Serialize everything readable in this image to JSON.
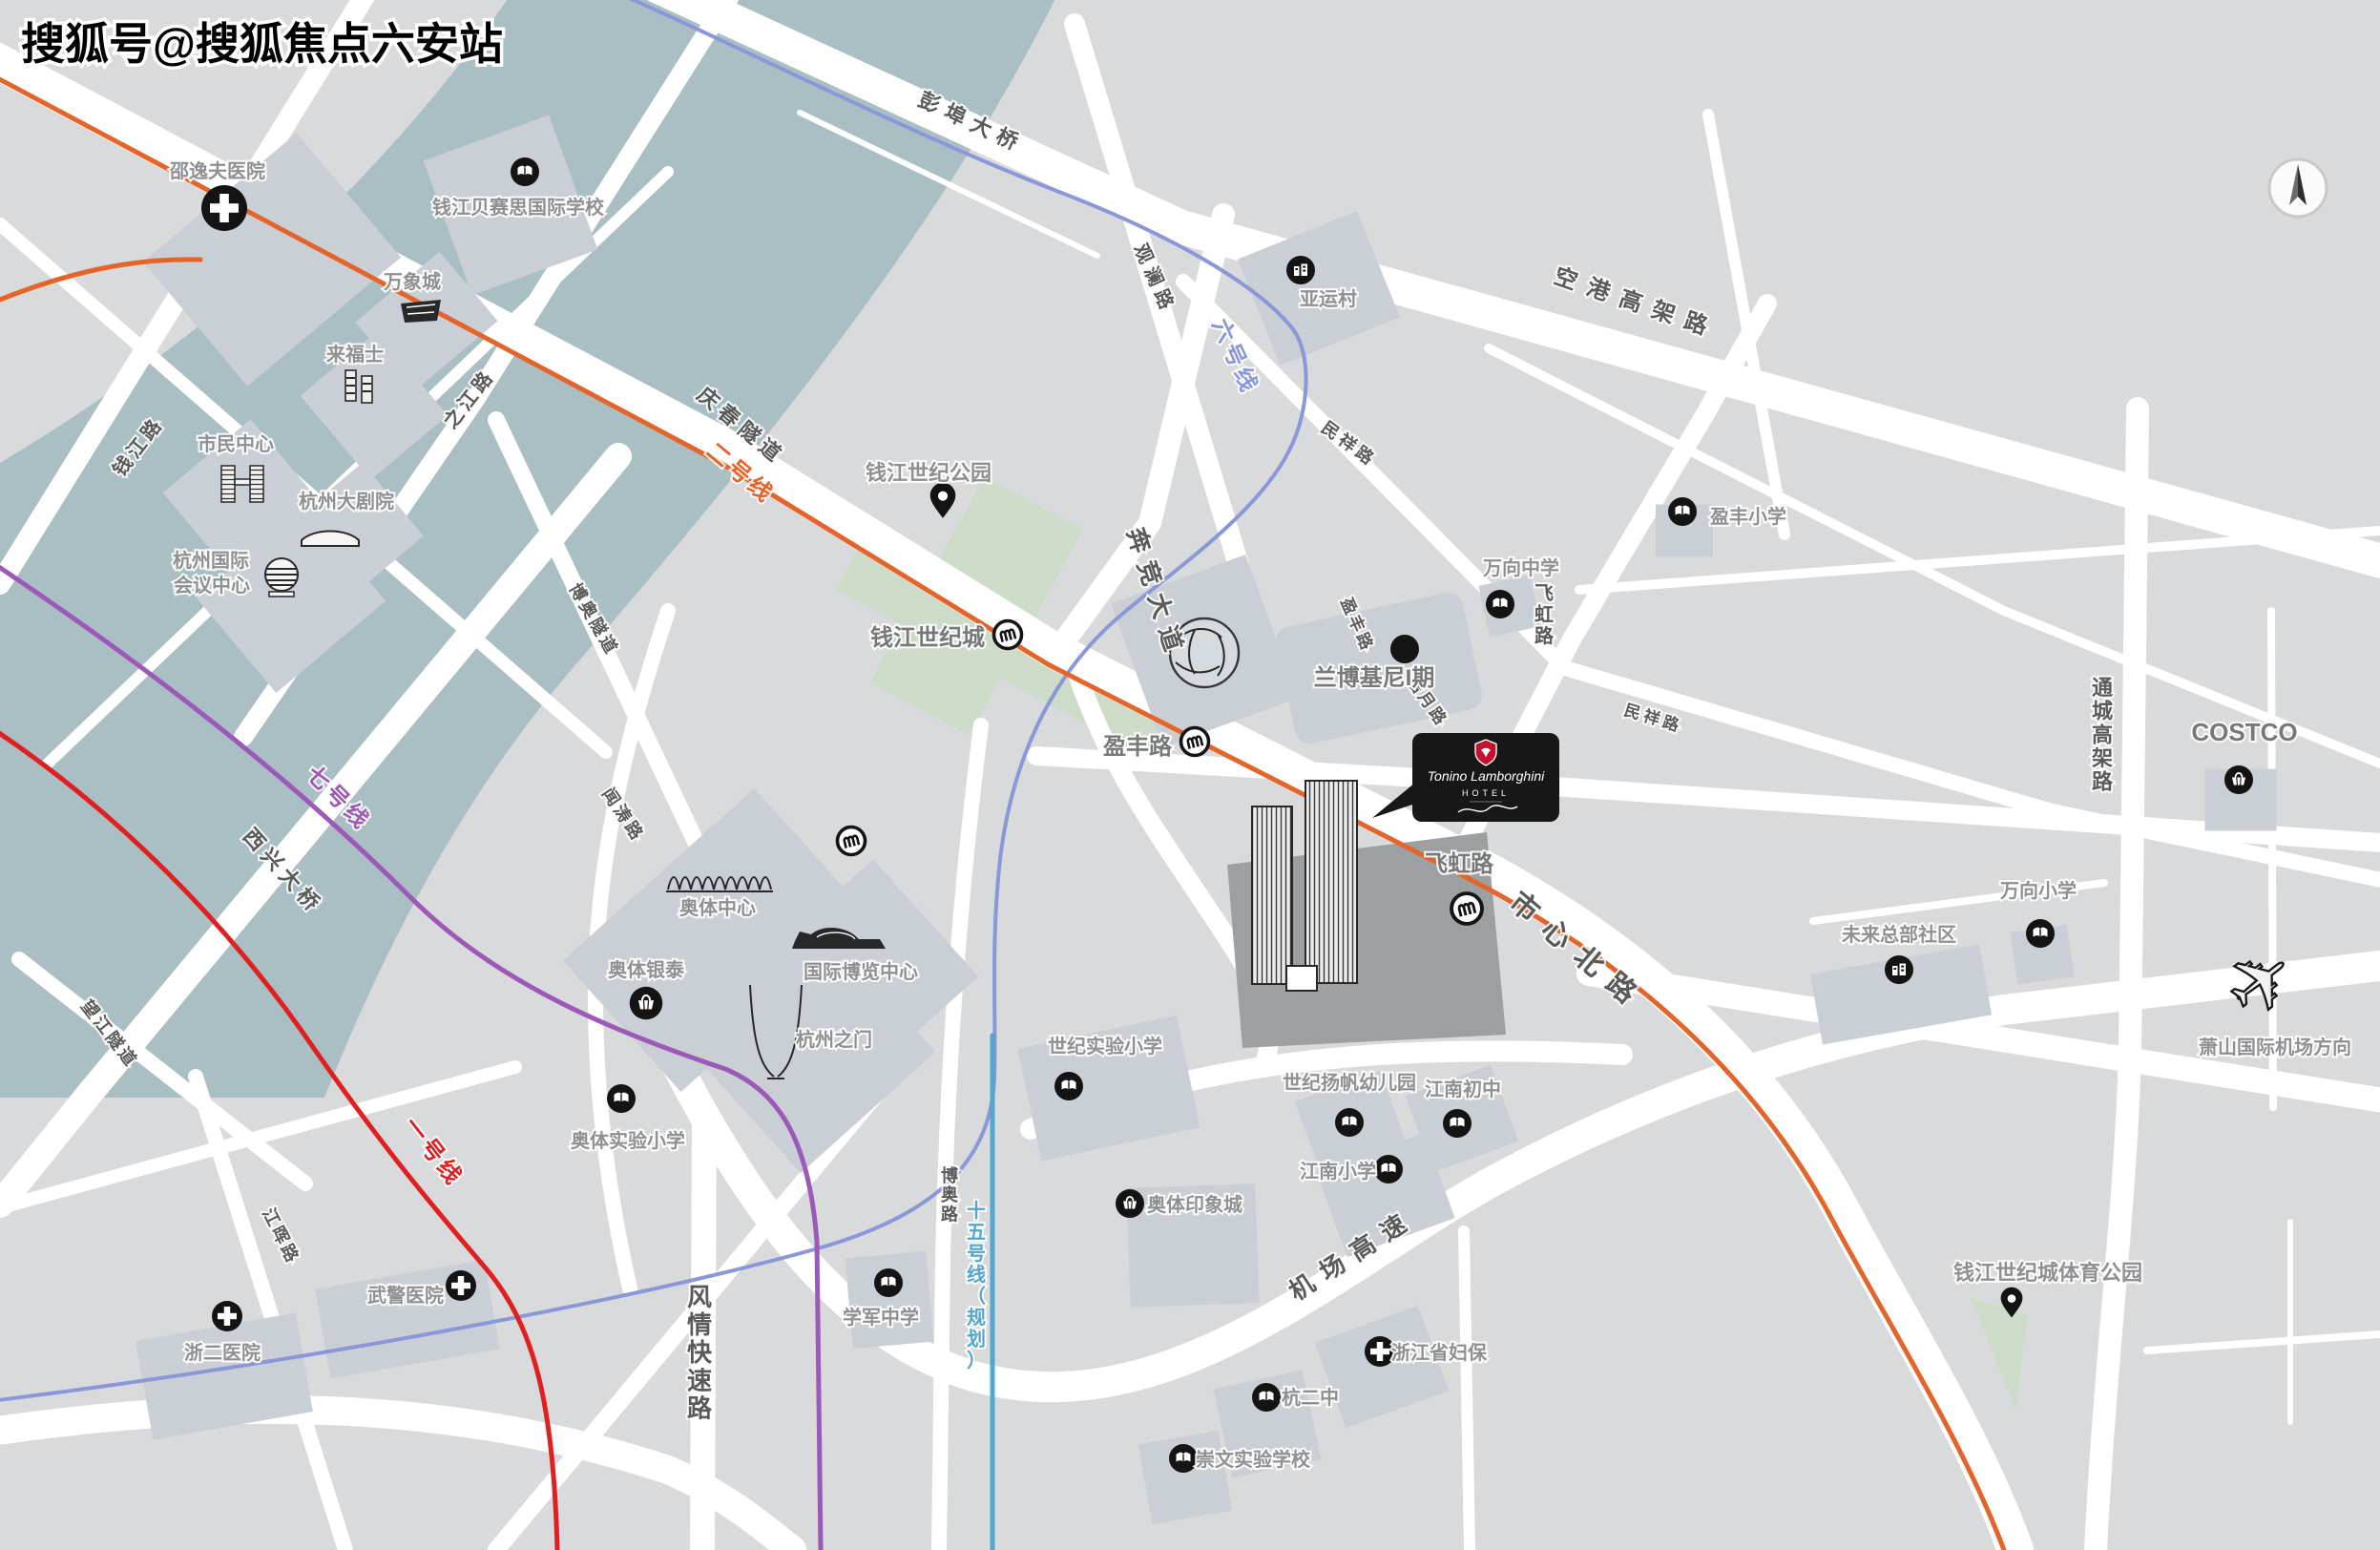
{
  "watermark": "搜狐号@搜狐焦点六安站",
  "colors": {
    "bg": "#d9dadb",
    "water": "#a9bfc4",
    "park": "#ccdcc8",
    "road": "#ffffff",
    "block": "#c9cfd5",
    "dark_plot": "#9da0a2",
    "label": "#8f9093",
    "road_label": "#5a5a5a",
    "line1": "#e02020",
    "line2": "#e4642a",
    "line6": "#8a97d8",
    "line7": "#9c59b8",
    "line15": "#53a7cf",
    "brand_red": "#c8102e",
    "card_bg": "#171717"
  },
  "hotel_card": {
    "brand": "Tonino Lamborghini",
    "type": "HOTEL"
  },
  "metro_lines": [
    {
      "name": "一号线",
      "color": "#e02020"
    },
    {
      "name": "二号线",
      "color": "#e4642a"
    },
    {
      "name": "六号线",
      "color": "#8a97d8"
    },
    {
      "name": "七号线",
      "color": "#9c59b8"
    },
    {
      "name": "十五号线（规划）",
      "color": "#53a7cf"
    }
  ],
  "labels": {
    "line1": "一号线",
    "line2": "二号线",
    "line6": "六号线",
    "line7": "七号线",
    "line15": "十五号线（规划）",
    "pengbu_bridge": "彭埠大桥",
    "qingchun_tunnel": "庆春隧道",
    "qianjiang_rd": "钱江路",
    "zhijiang_rd": "之江路",
    "guanlan_rd": "观澜路",
    "minxiang_rd": "民祥路",
    "minxiang_rd2": "民祥路",
    "benjing_ave": "奔竞大道",
    "yingfeng_rd": "盈丰路",
    "yingfeng_rd_diag": "盈丰路",
    "haoyue_rd": "皓月路",
    "feihong_rd": "飞虹路",
    "feihong_rd_v": "飞虹路",
    "shixin_north_rd": "市心北路",
    "konggang_elevated": "空港高架路",
    "tongcheng_elevated": "通城高架路",
    "jichang_expwy": "机场高速",
    "boao_rd": "博奥路",
    "boao_tunnel": "博奥隧道",
    "wentao_rd": "闻涛路",
    "fengqing_expwy": "风情快速路",
    "jianghui_rd": "江晖路",
    "wangjiang_tunnel": "望江隧道",
    "xixing_bridge": "西兴大桥",
    "shaoyifu_hospital": "邵逸夫医院",
    "basis_school": "钱江贝赛思国际学校",
    "mixc": "万象城",
    "raffles": "来福士",
    "citizen_center": "市民中心",
    "grand_theatre": "杭州大剧院",
    "icc_line1": "杭州国际",
    "icc_line2": "会议中心",
    "yayuncun": "亚运村",
    "qjsj_park": "钱江世纪公园",
    "qjsj_city": "钱江世纪城",
    "lamborghini_phase1": "兰博基尼I期",
    "wanxiang_middle": "万向中学",
    "yingfeng_primary": "盈丰小学",
    "costco": "COSTCO",
    "wanxiang_primary": "万向小学",
    "future_hq": "未来总部社区",
    "airport_direction": "萧山国际机场方向",
    "century_exp_primary": "世纪实验小学",
    "century_yangfan_kg": "世纪扬帆幼儿园",
    "jiangnan_junior": "江南初中",
    "jiangnan_primary": "江南小学",
    "aoti_impression": "奥体印象城",
    "zj_women_hospital": "浙江省妇保",
    "hang2_school": "杭二中",
    "chongwen_school": "崇文实验学校",
    "aoti_center": "奥体中心",
    "aoti_intime": "奥体银泰",
    "intl_expo": "国际博览中心",
    "hangzhou_gate": "杭州之门",
    "aoti_exp_primary": "奥体实验小学",
    "xuejun_middle": "学军中学",
    "wujing_hospital": "武警医院",
    "zheer_hospital": "浙二医院",
    "sports_park": "钱江世纪城体育公园"
  }
}
